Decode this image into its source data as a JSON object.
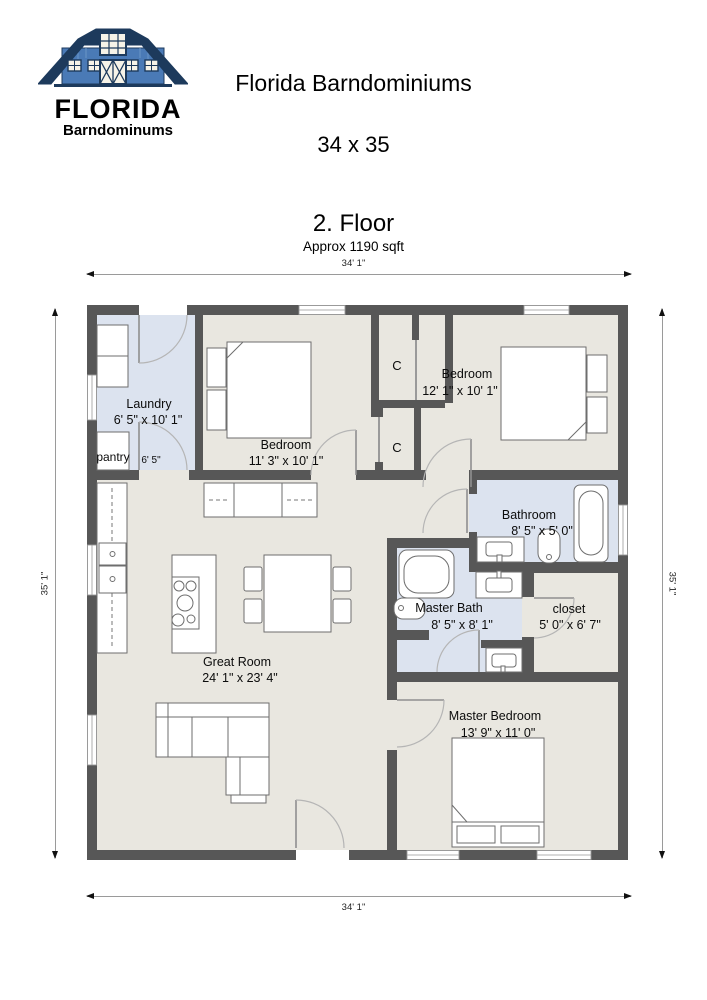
{
  "logo": {
    "brand": "FLORIDA",
    "subtitle": "Barndominums"
  },
  "header": {
    "title": "Florida Barndominiums",
    "plan_size": "34 x 35"
  },
  "plan": {
    "floor_label": "2. Floor",
    "area_label": "Approx 1190 sqft"
  },
  "dimensions": {
    "top": "34' 1\"",
    "bottom": "34' 1\"",
    "left": "35' 1\"",
    "right": "35' 1\""
  },
  "rooms": {
    "laundry": {
      "name": "Laundry",
      "dims": "6' 5\" x 10' 1\""
    },
    "pantry": {
      "name": "pantry",
      "dims": "6' 5\""
    },
    "bedroom1": {
      "name": "Bedroom",
      "dims": "11' 3\" x 10' 1\""
    },
    "closet_top": {
      "name": "C"
    },
    "closet_bottom": {
      "name": "C"
    },
    "bedroom2": {
      "name": "Bedroom",
      "dims": "12' 1\" x 10' 1\""
    },
    "bathroom": {
      "name": "Bathroom",
      "dims": "8' 5\" x 5' 0\""
    },
    "master_bath": {
      "name": "Master Bath",
      "dims": "8' 5\" x 8' 1\""
    },
    "closet": {
      "name": "closet",
      "dims": "5' 0\" x 6' 7\""
    },
    "great_room": {
      "name": "Great Room",
      "dims": "24' 1\" x 23' 4\""
    },
    "master_bedroom": {
      "name": "Master Bedroom",
      "dims": "13' 9\" x 11' 0\""
    }
  },
  "colors": {
    "wall": "#575757",
    "floor": "#e9e7e0",
    "wet_floor": "#dce3ef",
    "logo_blue": "#4a7ab6",
    "logo_navy": "#1d3a5c"
  }
}
